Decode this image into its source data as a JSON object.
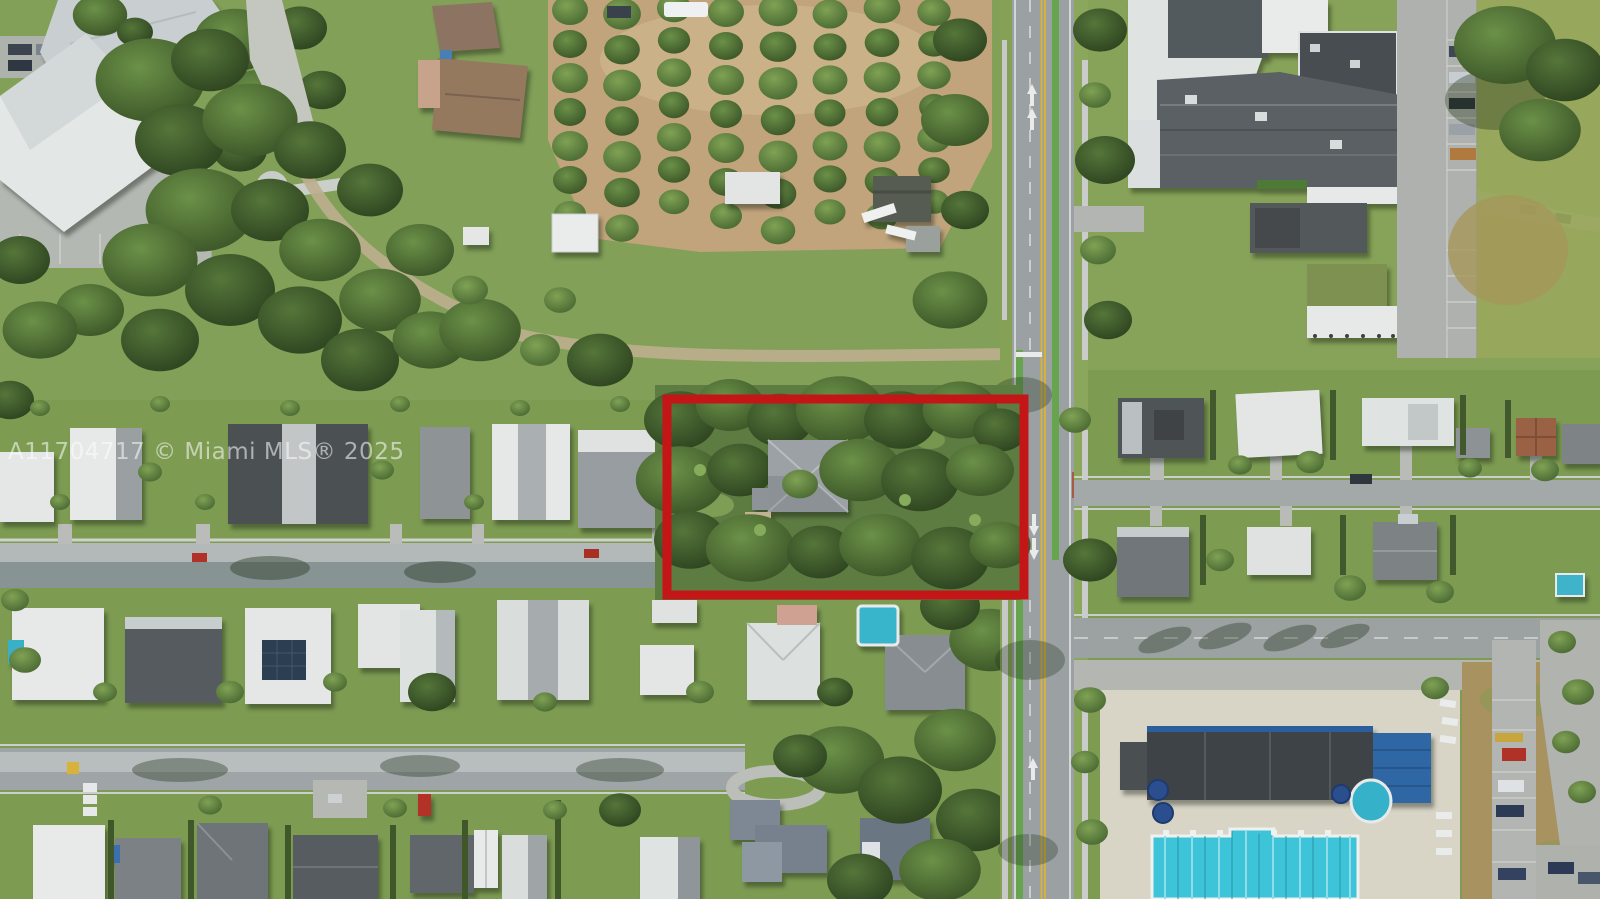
{
  "image": {
    "type": "aerial-drone-photograph",
    "subject": "Suburban neighborhood aerial view with a vacant treed parcel outlined in red beside a north-south highway, orchard rows, residential streets and a community pool",
    "width_px": 1600,
    "height_px": 899
  },
  "watermark": {
    "text": "A11704717 © Miami MLS® 2025",
    "color": "#ffffff",
    "opacity": 0.55
  },
  "annotation": {
    "label": "property-boundary",
    "shape": "rectangle",
    "x": 667,
    "y": 399,
    "width": 357,
    "height": 196,
    "stroke_color": "#c41616",
    "stroke_width": 9
  },
  "palette": {
    "grass": "#7d9c52",
    "tree_canopy": "#3a5229",
    "orchard_soil": "#c1a47c",
    "asphalt": "#9ba1a3",
    "concrete": "#b9bebf",
    "roof_white": "#e6e9e8",
    "roof_gray": "#8b9194",
    "roof_dark": "#4c5154",
    "roof_brown": "#94795f",
    "pool_water": "#3ec4d8",
    "bike_lane_green": "#66a44e",
    "lane_yellow": "#d7b13e",
    "shade_structure_blue": "#2f66a4",
    "field_brown": "#a8925f"
  }
}
